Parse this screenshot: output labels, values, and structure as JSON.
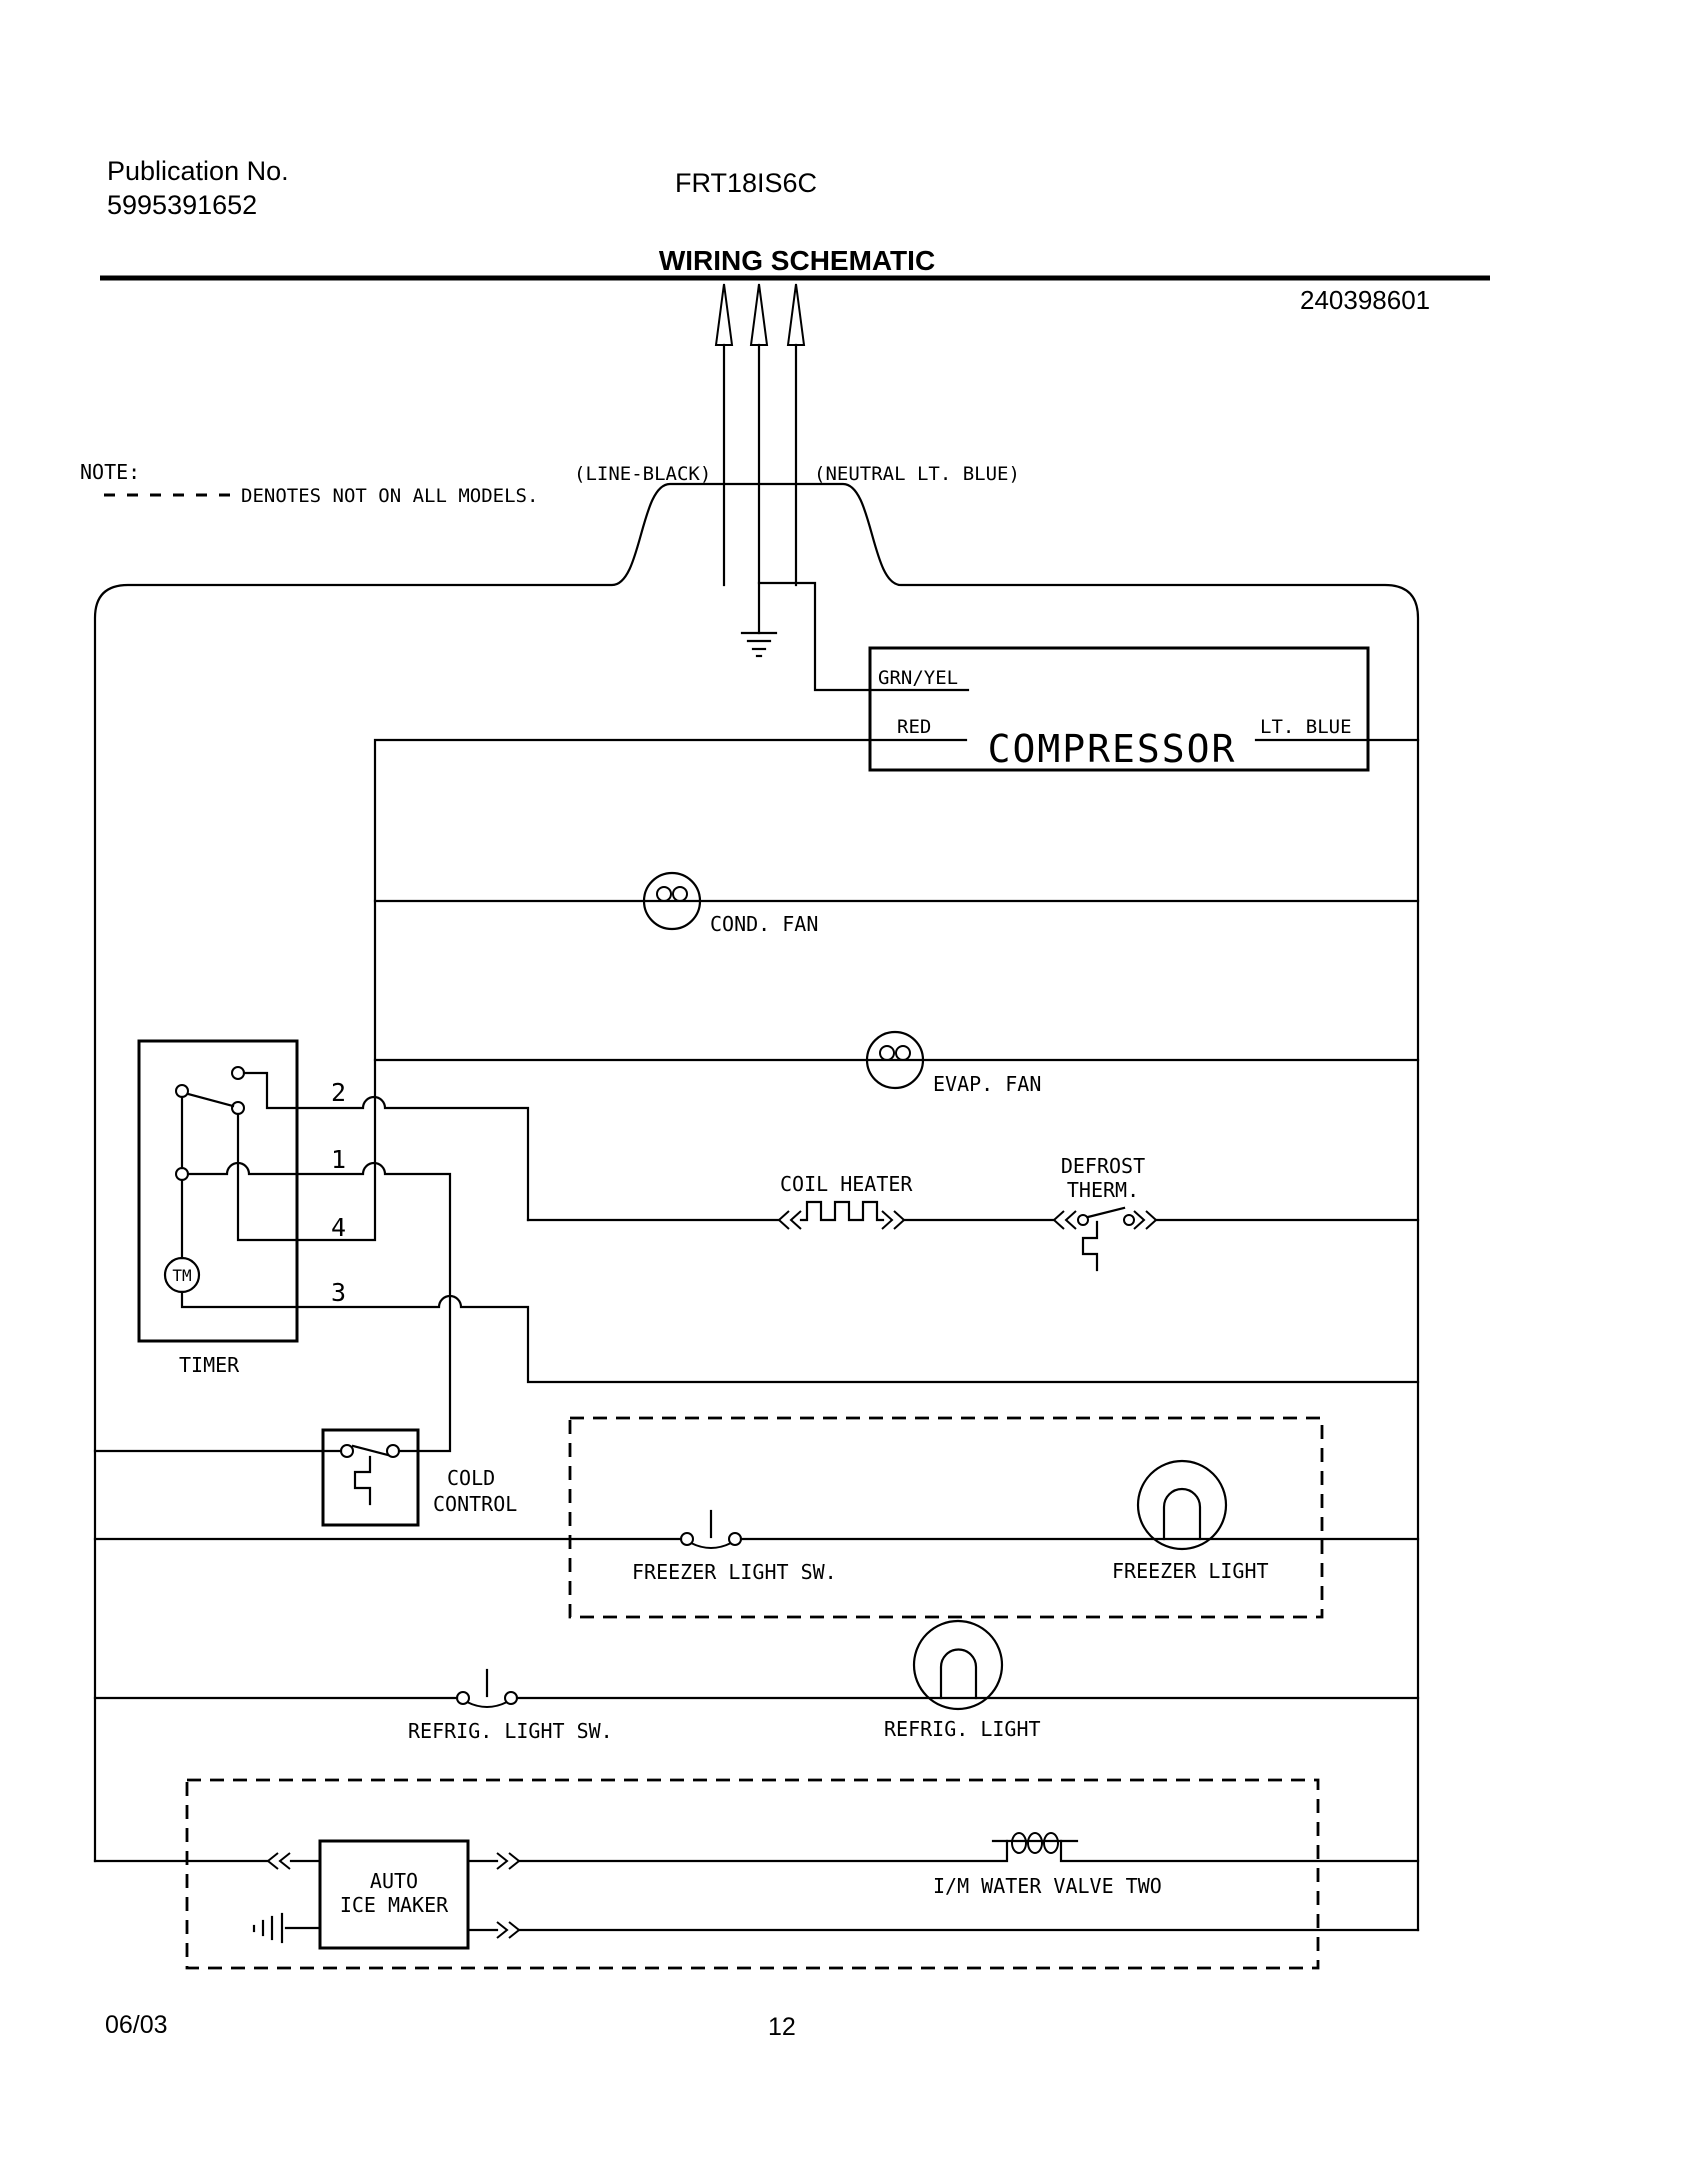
{
  "header": {
    "publication_label": "Publication No.",
    "publication_number": "5995391652",
    "model": "FRT18IS6C",
    "title": "WIRING SCHEMATIC",
    "part_number": "240398601"
  },
  "power": {
    "line_label": "(LINE-BLACK)",
    "neutral_label": "(NEUTRAL LT. BLUE)"
  },
  "note": {
    "label": "NOTE:",
    "text": "DENOTES NOT ON ALL MODELS."
  },
  "components": {
    "compressor": {
      "label": "COMPRESSOR",
      "terminals": [
        "GRN/YEL",
        "RED",
        "LT. BLUE"
      ]
    },
    "cond_fan": "COND. FAN",
    "evap_fan": "EVAP. FAN",
    "timer": {
      "label": "TIMER",
      "motor": "TM",
      "terminals": [
        "2",
        "1",
        "4",
        "3"
      ]
    },
    "coil_heater": "COIL HEATER",
    "defrost_therm": [
      "DEFROST",
      "THERM."
    ],
    "cold_control": [
      "COLD",
      "CONTROL"
    ],
    "freezer_light_sw": "FREEZER LIGHT SW.",
    "freezer_light": "FREEZER LIGHT",
    "refrig_light_sw": "REFRIG. LIGHT SW.",
    "refrig_light": "REFRIG. LIGHT",
    "ice_maker": [
      "AUTO",
      "ICE MAKER"
    ],
    "water_valve": "I/M WATER VALVE TWO"
  },
  "footer": {
    "date": "06/03",
    "page": "12"
  },
  "colors": {
    "ink": "#000000",
    "paper": "#ffffff"
  }
}
